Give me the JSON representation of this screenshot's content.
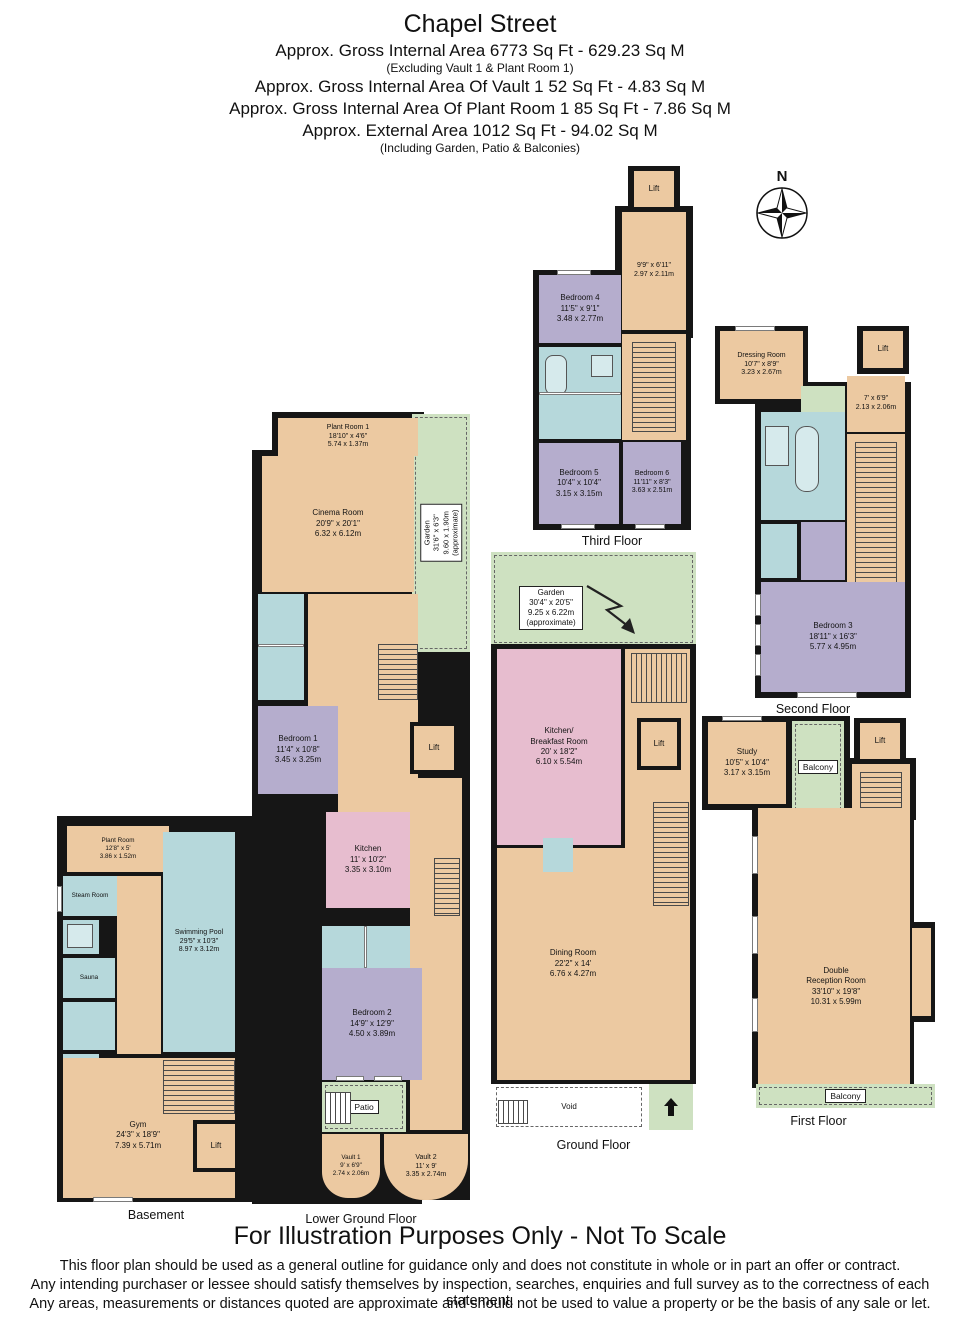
{
  "header": {
    "title": "Chapel Street",
    "gross_internal": "Approx. Gross Internal Area   6773 Sq Ft  -  629.23 Sq M",
    "gross_note": "(Excluding Vault 1 & Plant Room 1)",
    "vault_line": "Approx. Gross Internal Area Of Vault 1 52 Sq Ft  -  4.83 Sq M",
    "plant_line": "Approx. Gross Internal Area Of Plant Room 1 85 Sq Ft  -  7.86 Sq M",
    "external_line": "Approx. External Area  1012 Sq Ft  -  94.02 Sq M",
    "external_note": "(Including Garden, Patio & Balconies)"
  },
  "compass": {
    "north": "N"
  },
  "floor_labels": {
    "third": "Third Floor",
    "second": "Second Floor",
    "first": "First Floor",
    "ground": "Ground Floor",
    "lower_ground": "Lower Ground Floor",
    "basement": "Basement"
  },
  "rooms": {
    "tf_lift": {
      "name": "Lift"
    },
    "tf_hall": {
      "ft": "9'9\" x 6'11\"",
      "m": "2.97 x 2.11m"
    },
    "bedroom4": {
      "name": "Bedroom 4",
      "ft": "11'5\" x 9'1\"",
      "m": "3.48 x 2.77m"
    },
    "bedroom5": {
      "name": "Bedroom 5",
      "ft": "10'4\" x 10'4\"",
      "m": "3.15 x 3.15m"
    },
    "bedroom6": {
      "name": "Bedroom 6",
      "ft": "11'11\" x 8'3\"",
      "m": "3.63 x 2.51m"
    },
    "dressing": {
      "name": "Dressing Room",
      "ft": "10'7\" x 8'9\"",
      "m": "3.23 x 2.67m"
    },
    "sf_lift": {
      "name": "Lift"
    },
    "sf_hall": {
      "ft": "7' x 6'9\"",
      "m": "2.13 x 2.06m"
    },
    "bedroom3": {
      "name": "Bedroom 3",
      "ft": "18'11\" x 16'3\"",
      "m": "5.77 x 4.95m"
    },
    "study": {
      "name": "Study",
      "ft": "10'5\" x 10'4\"",
      "m": "3.17 x 3.15m"
    },
    "balcony_top": {
      "name": "Balcony"
    },
    "balcony_bottom": {
      "name": "Balcony"
    },
    "ff_lift": {
      "name": "Lift"
    },
    "reception": {
      "name1": "Double",
      "name2": "Reception Room",
      "ft": "33'10\" x 19'8\"",
      "m": "10.31 x 5.99m"
    },
    "gf_garden": {
      "name": "Garden",
      "ft": "30'4\" x 20'5\"",
      "m": "9.25 x 6.22m",
      "note": "(approximate)"
    },
    "kitchen_breakfast": {
      "name1": "Kitchen/",
      "name2": "Breakfast Room",
      "ft": "20' x 18'2\"",
      "m": "6.10 x 5.54m"
    },
    "gf_lift": {
      "name": "Lift"
    },
    "dining": {
      "name": "Dining Room",
      "ft": "22'2\" x 14'",
      "m": "6.76 x 4.27m"
    },
    "void": {
      "name": "Void"
    },
    "plant1": {
      "name": "Plant Room 1",
      "ft": "18'10\" x 4'6\"",
      "m": "5.74 x 1.37m"
    },
    "cinema": {
      "name": "Cinema Room",
      "ft": "20'9\" x 20'1\"",
      "m": "6.32 x 6.12m"
    },
    "lg_garden": {
      "name": "Garden",
      "ft": "31'6\" x 6'3\"",
      "m": "9.60 x 1.90m",
      "note": "(approximate)"
    },
    "bedroom1": {
      "name": "Bedroom 1",
      "ft": "11'4\" x 10'8\"",
      "m": "3.45 x 3.25m"
    },
    "lg_lift": {
      "name": "Lift"
    },
    "lg_kitchen": {
      "name": "Kitchen",
      "ft": "11' x 10'2\"",
      "m": "3.35 x 3.10m"
    },
    "bedroom2": {
      "name": "Bedroom 2",
      "ft": "14'9\" x 12'9\"",
      "m": "4.50 x 3.89m"
    },
    "patio": {
      "name": "Patio"
    },
    "vault1": {
      "name": "Vault 1",
      "ft": "9' x 6'9\"",
      "m": "2.74 x 2.06m"
    },
    "vault2": {
      "name": "Vault 2",
      "ft": "11' x 9'",
      "m": "3.35 x 2.74m"
    },
    "plant_b": {
      "name": "Plant Room",
      "ft": "12'8\" x 5'",
      "m": "3.86 x 1.52m"
    },
    "steam": {
      "name": "Steam Room"
    },
    "sauna": {
      "name": "Sauna"
    },
    "pool": {
      "name": "Swimming Pool",
      "ft": "29'5\" x 10'3\"",
      "m": "8.97 x 3.12m"
    },
    "gym": {
      "name": "Gym",
      "ft": "24'3\" x 18'9\"",
      "m": "7.39 x 5.71m"
    },
    "b_lift": {
      "name": "Lift"
    }
  },
  "footer": {
    "notice": "For Illustration Purposes Only - Not To Scale",
    "disclaimer1": "This floor plan should be used as a general outline for guidance only and does not constitute in whole or in part an offer or contract.",
    "disclaimer2": "Any intending purchaser or lessee should satisfy themselves by inspection, searches, enquiries and full survey as to the correctness of each statement.",
    "disclaimer3": "Any areas, measurements or distances quoted are approximate and should not be used to value a property or be the basis of any sale or let."
  },
  "palette": {
    "wall": "#161616",
    "room_tan": "#ecc9a1",
    "bedroom_purple": "#b5adcd",
    "bath_blue": "#b6d8db",
    "outdoor_green": "#cee1c1",
    "kitchen_pink": "#e7bdcf"
  }
}
